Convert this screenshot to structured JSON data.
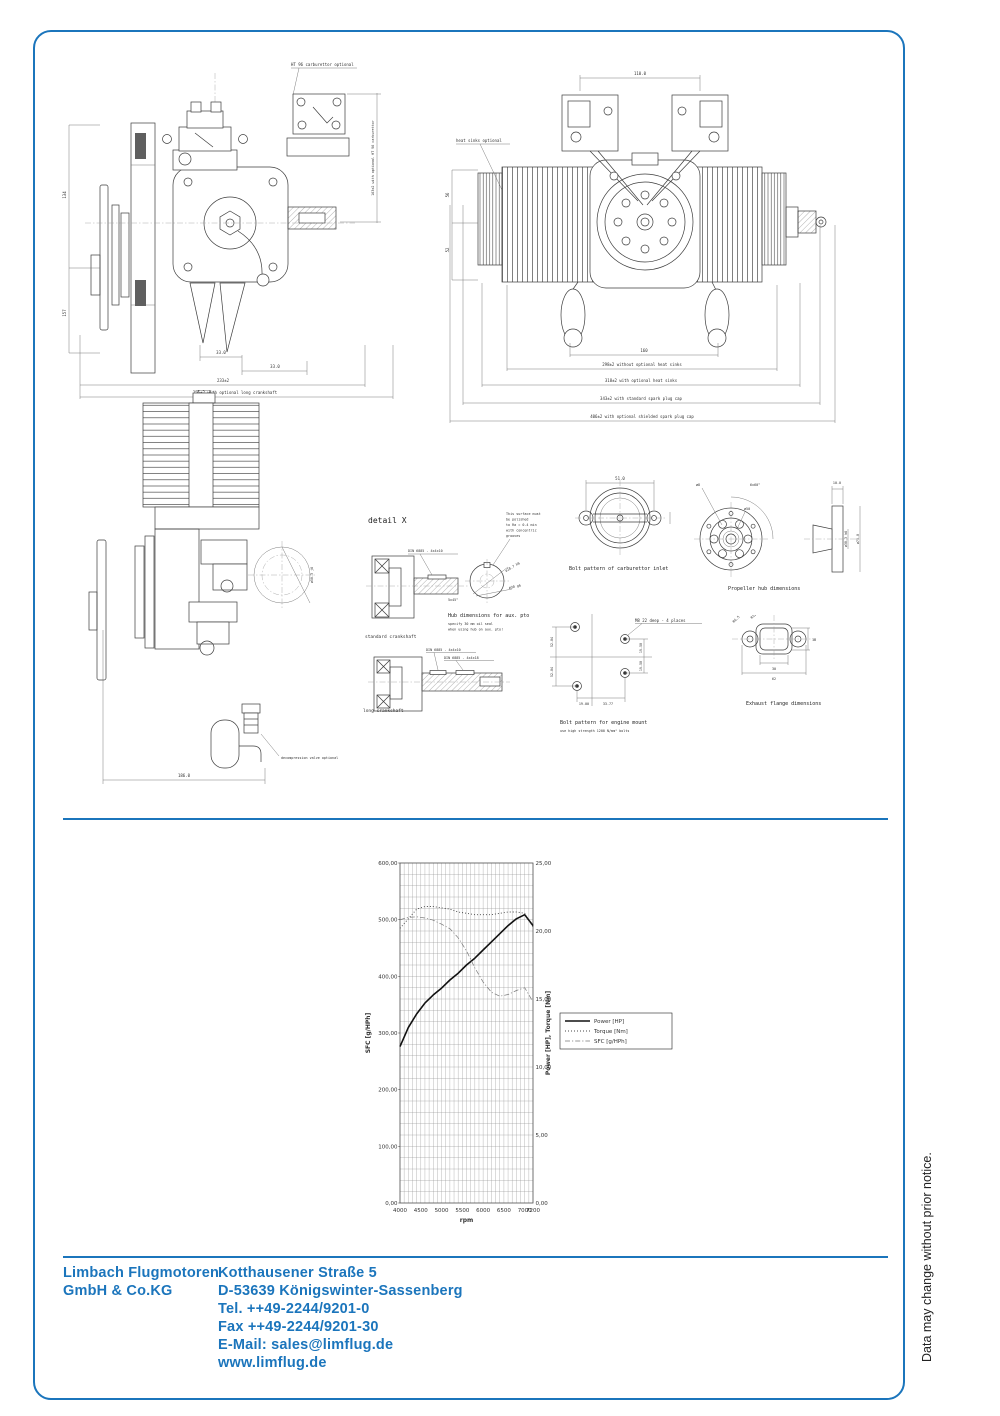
{
  "page": {
    "side_note": "Data may change without prior notice."
  },
  "colors": {
    "accent": "#1b75bc",
    "ink": "#3d3d3d"
  },
  "footer": {
    "company": [
      "Limbach Flugmotoren",
      "GmbH & Co.KG"
    ],
    "address": [
      "Kotthausener Straße 5",
      "D-53639 Königswinter-Sassenberg",
      "Tel.  ++49-2244/9201-0",
      "Fax  ++49-2244/9201-30",
      "E-Mail: sales@limflug.de",
      "www.limflug.de"
    ]
  },
  "drawings": {
    "side_view": {
      "dim_left_top": "134",
      "dim_left_bottom": "157",
      "dim_a": "33.0",
      "dim_b": "33.0",
      "dim_total": "233±2",
      "dim_total_long": "255±2 with optional long crankshaft",
      "carb_note": "HT 96 carburettor optional",
      "carb_height": "163±2 with optional HT 96 carburettor"
    },
    "front_view": {
      "heat_sink_note": "heat sinks optional",
      "dim_top": "110.0",
      "dim_left_top": "56",
      "dim_left_bottom": "52",
      "dim_w1": "160",
      "dim_w2": "298±2 without optional heat sinks",
      "dim_w3": "318±2 with optional heat sinks",
      "dim_w4": "343±2 with standard spark plug cap",
      "dim_w5": "406±2 with optional shielded spark plug cap"
    },
    "rear_view": {
      "shaft_dim": "ø50.3 j6",
      "valve_note": "decompression valve optional",
      "dim_width": "186.0"
    },
    "detail_x": {
      "title": "detail X",
      "key_spec": "DIN 6885 - 4x4x10",
      "chamfer": "5x45°",
      "caption_std": "standard crankshaft",
      "key_spec2a": "DIN 6885 - 4x4x10",
      "key_spec2b": "DIN 6885 - 4x4x18",
      "caption_long": "long crankshaft"
    },
    "aux_pto": {
      "surface_note_lines": [
        "This surface must",
        "be polished",
        "to Ra = 0.4 min",
        "with concentric",
        "grooves"
      ],
      "dim1": "ø18.7 h6",
      "dim2": "ø30 g6",
      "caption": "Hub dimensions for aux. pto",
      "note_line1": "specify 30 mm oil seal",
      "note_line2": "when using hub on aux. pto!"
    },
    "carb_inlet": {
      "dim_top": "51.0",
      "caption": "Bolt pattern of carburettor inlet"
    },
    "prop_hub": {
      "bolt_circle": "6x60°",
      "hole": "ø8",
      "circle": "ø50",
      "depth": "10.0",
      "bore": "ø30.3 h6",
      "od": "ø75.0",
      "caption": "Propeller hub dimensions"
    },
    "engine_mount": {
      "thread_note": "M8 22 deep - 4 places",
      "dim_v1": "52.04",
      "dim_v2": "52.04",
      "dim_r1": "19.50",
      "dim_r2": "19.50",
      "dim_b1": "19.00",
      "dim_b2": "33.77",
      "caption": "Bolt pattern for engine mount",
      "note": "use high strength 1200 N/mm² bolts"
    },
    "exhaust_flange": {
      "r1": "R6.5",
      "r2": "R12.5",
      "dim_h": "18",
      "dim_w1": "30",
      "dim_w2": "62",
      "caption": "Exhaust flange dimensions"
    }
  },
  "chart_data": {
    "type": "line",
    "title": "",
    "xlabel": "rpm",
    "ylabel_left": "SFC [g/HPh]",
    "ylabel_right": "Power [HP], Torque [Nm]",
    "xlim": [
      4000,
      7200
    ],
    "ylim_left": [
      0,
      600
    ],
    "ylim_right": [
      0,
      25
    ],
    "x_ticks": [
      4000,
      4500,
      5000,
      5500,
      6000,
      6500,
      7000,
      7200
    ],
    "y_ticks_left": [
      0,
      100,
      200,
      300,
      400,
      500,
      600
    ],
    "y_ticks_right": [
      0,
      5,
      10,
      15,
      20,
      25
    ],
    "grid_step_x": 100,
    "grid_step_y_left": 20,
    "grid": true,
    "legend_position": "right",
    "x": [
      4000,
      4200,
      4400,
      4600,
      4800,
      5000,
      5200,
      5400,
      5600,
      5800,
      6000,
      6200,
      6400,
      6600,
      6800,
      7000,
      7200
    ],
    "series": [
      {
        "name": "Power [HP]",
        "axis": "right",
        "style": "solid",
        "values": [
          11.5,
          12.9,
          13.9,
          14.7,
          15.3,
          15.8,
          16.4,
          16.9,
          17.5,
          18.0,
          18.6,
          19.2,
          19.8,
          20.4,
          20.9,
          21.2,
          20.4
        ]
      },
      {
        "name": "Torque [Nm]",
        "axis": "right",
        "style": "dotted",
        "values": [
          20.2,
          20.9,
          21.6,
          21.8,
          21.8,
          21.7,
          21.6,
          21.4,
          21.3,
          21.2,
          21.2,
          21.2,
          21.3,
          21.4,
          21.4,
          21.3,
          20.3
        ]
      },
      {
        "name": "SFC [g/HPh]",
        "axis": "left",
        "style": "dashdot",
        "values": [
          500,
          504,
          505,
          503,
          499,
          492,
          484,
          468,
          445,
          415,
          390,
          372,
          365,
          368,
          375,
          380,
          355
        ]
      }
    ]
  }
}
